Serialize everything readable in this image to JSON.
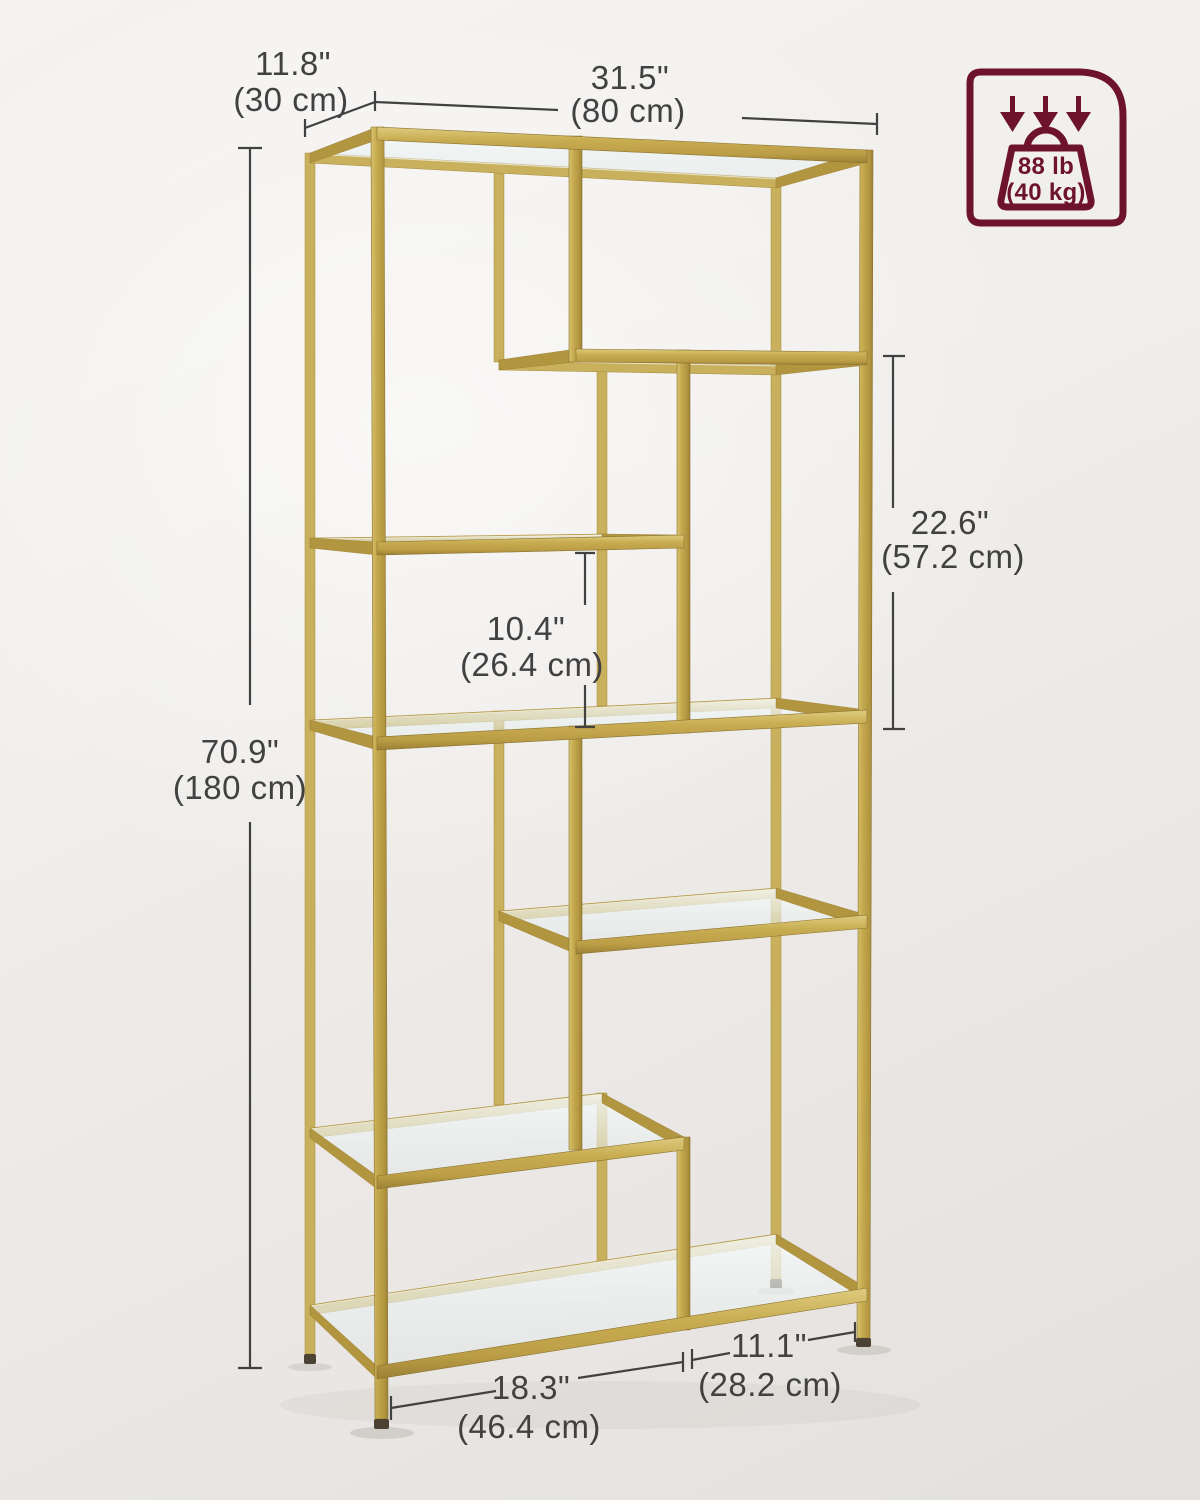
{
  "colors": {
    "gold": "#c8ac51",
    "gold_dark": "#9c8136",
    "glass": "#eef4f4",
    "dimension_line": "#414141",
    "badge_maroon": "#6e132c",
    "background": "#efede9"
  },
  "capacity_badge": {
    "icon": "weight-capacity-icon",
    "arrows_icon": "triple-down-arrow-icon",
    "weight_icon": "kettlebell-weight-icon",
    "load_imperial": "88 lb",
    "load_metric": "(40 kg)"
  },
  "dimensions": {
    "depth": {
      "imperial": "11.8\"",
      "metric": "(30 cm)"
    },
    "width": {
      "imperial": "31.5\"",
      "metric": "(80 cm)"
    },
    "height": {
      "imperial": "70.9\"",
      "metric": "(180 cm)"
    },
    "middle_shelf_gap": {
      "imperial": "10.4\"",
      "metric": "(26.4 cm)"
    },
    "right_compartment_height": {
      "imperial": "22.6\"",
      "metric": "(57.2 cm)"
    },
    "bottom_shelf_left_width": {
      "imperial": "18.3\"",
      "metric": "(46.4 cm)"
    },
    "bottom_shelf_right_width": {
      "imperial": "11.1\"",
      "metric": "(28.2 cm)"
    }
  }
}
